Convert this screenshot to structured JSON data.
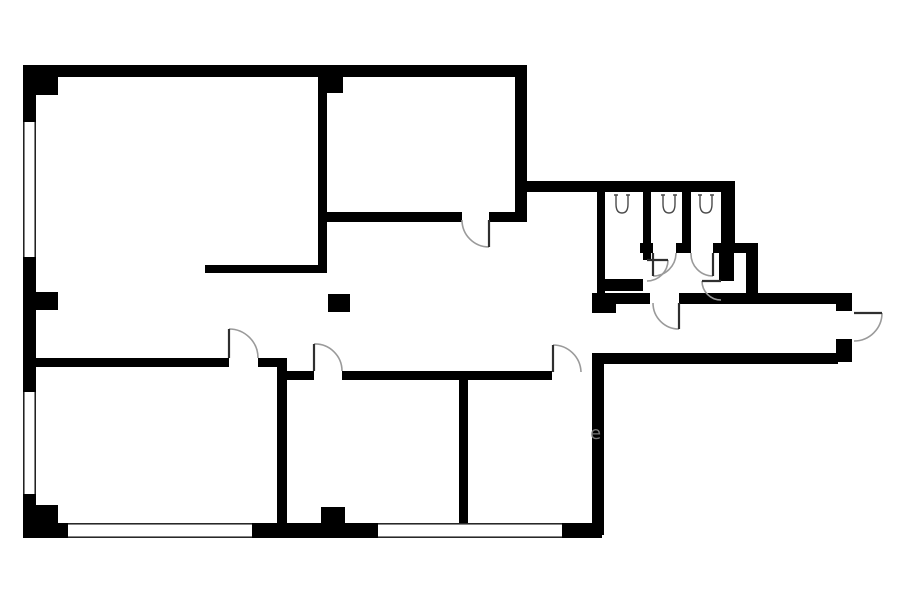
{
  "page": {
    "background": "#ffffff"
  },
  "floor_plan": {
    "type": "architectural-floor-plan",
    "canvas": {
      "width": 900,
      "height": 604
    },
    "colors": {
      "wall": "#000000",
      "window_line": "#0a0a0a",
      "door_arc": "#9a9a9a",
      "door_leaf": "#2f2f2f",
      "fixture": "#4a4a4a",
      "watermark": "#8d8d8d"
    },
    "walls": [
      [
        23,
        65,
        504,
        12
      ],
      [
        23,
        65,
        13,
        57
      ],
      [
        23,
        257,
        13,
        135
      ],
      [
        23,
        494,
        13,
        44
      ],
      [
        36,
        75,
        22,
        20
      ],
      [
        36,
        292,
        22,
        18
      ],
      [
        36,
        505,
        22,
        20
      ],
      [
        23,
        523,
        45,
        15
      ],
      [
        252,
        523,
        126,
        15
      ],
      [
        562,
        523,
        40,
        15
      ],
      [
        592,
        356,
        12,
        179
      ],
      [
        515,
        65,
        12,
        157
      ],
      [
        527,
        181,
        70,
        11
      ],
      [
        318,
        65,
        9,
        208
      ],
      [
        327,
        77,
        16,
        16
      ],
      [
        318,
        212,
        144,
        10
      ],
      [
        489,
        212,
        38,
        10
      ],
      [
        205,
        265,
        122,
        8
      ],
      [
        328,
        294,
        22,
        18
      ],
      [
        36,
        358,
        193,
        9
      ],
      [
        258,
        358,
        29,
        9
      ],
      [
        277,
        358,
        10,
        180
      ],
      [
        287,
        371,
        27,
        9
      ],
      [
        342,
        371,
        210,
        9
      ],
      [
        459,
        375,
        9,
        150
      ],
      [
        321,
        507,
        24,
        17
      ],
      [
        597,
        181,
        138,
        11
      ],
      [
        597,
        181,
        8,
        122
      ],
      [
        597,
        293,
        53,
        11
      ],
      [
        679,
        293,
        79,
        11
      ],
      [
        592,
        293,
        24,
        20
      ],
      [
        643,
        192,
        8,
        68
      ],
      [
        682,
        192,
        9,
        61
      ],
      [
        640,
        243,
        13,
        10
      ],
      [
        676,
        243,
        15,
        10
      ],
      [
        713,
        243,
        45,
        10
      ],
      [
        605,
        279,
        38,
        12
      ],
      [
        721,
        181,
        14,
        62
      ],
      [
        746,
        243,
        12,
        60
      ],
      [
        719,
        253,
        15,
        28
      ],
      [
        758,
        293,
        80,
        11
      ],
      [
        836,
        293,
        16,
        18
      ],
      [
        592,
        353,
        246,
        11
      ],
      [
        836,
        339,
        16,
        23
      ]
    ],
    "windows": [
      {
        "x": 23,
        "y": 122,
        "w": 13,
        "h": 135,
        "dir": "v"
      },
      {
        "x": 23,
        "y": 392,
        "w": 13,
        "h": 102,
        "dir": "v"
      },
      {
        "x": 68,
        "y": 523,
        "w": 184,
        "h": 15,
        "dir": "h"
      },
      {
        "x": 378,
        "y": 523,
        "w": 184,
        "h": 15,
        "dir": "h"
      }
    ],
    "doors": [
      {
        "name": "door-top-middle-room",
        "leaf": [
          489,
          220,
          489,
          247
        ],
        "arc": "M462,220 A27,27 0 0 0 489,247"
      },
      {
        "name": "door-bottom-left-room",
        "leaf": [
          229,
          358,
          229,
          329
        ],
        "arc": "M229,329 A29,29 0 0 1 258,358"
      },
      {
        "name": "door-bottom-middle-room",
        "leaf": [
          314,
          371,
          314,
          344
        ],
        "arc": "M314,344 A27,27 0 0 1 342,371"
      },
      {
        "name": "door-bottom-right-room",
        "leaf": [
          553,
          372,
          553,
          345
        ],
        "arc": "M553,345 A28,28 0 0 1 581,372"
      },
      {
        "name": "door-wc-lobby-entry",
        "leaf": [
          679,
          303,
          679,
          329
        ],
        "arc": "M653,303 A26,26 0 0 0 679,329"
      },
      {
        "name": "door-wc-stall-1",
        "leaf": [
          647,
          260,
          668,
          260
        ],
        "arc": "M668,260 A21,21 0 0 1 647,281"
      },
      {
        "name": "door-wc-stall-2",
        "leaf": [
          653,
          253,
          653,
          276
        ],
        "arc": "M676,253 A23,23 0 0 1 653,276"
      },
      {
        "name": "door-wc-stall-3",
        "leaf": [
          713,
          253,
          713,
          276
        ],
        "arc": "M691,253 A22,22 0 0 0 713,276"
      },
      {
        "name": "door-wc-right-section",
        "leaf": [
          721,
          281,
          702,
          281
        ],
        "arc": "M702,281 A19,19 0 0 0 721,300"
      },
      {
        "name": "door-main-entrance",
        "leaf": [
          854,
          313,
          882,
          313
        ],
        "arc": "M882,313 A28,28 0 0 1 854,341"
      }
    ],
    "toilets": [
      {
        "x": 614,
        "y": 193
      },
      {
        "x": 661,
        "y": 193
      },
      {
        "x": 698,
        "y": 193
      }
    ],
    "watermark": {
      "text": "e",
      "x": 590,
      "y": 439,
      "size": 18
    }
  }
}
